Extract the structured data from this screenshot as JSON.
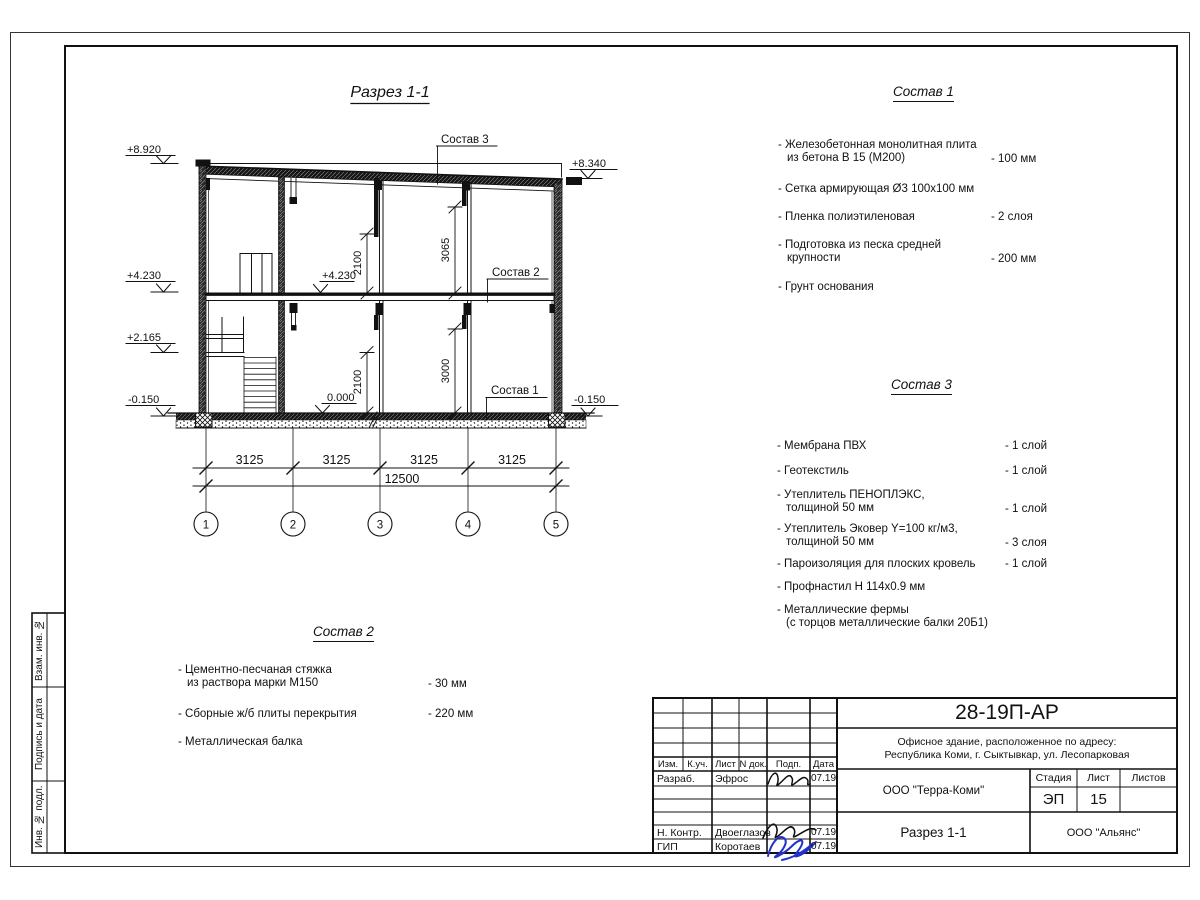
{
  "drawing": {
    "title": "Разрез 1-1",
    "elev": {
      "e8920": "+8.920",
      "e8340": "+8.340",
      "e4230m": "+4.230",
      "e2165": "+2.165",
      "e0150l": "-0.150",
      "e0150r": "-0.150",
      "e4230i": "+4.230",
      "e0000": "0.000"
    },
    "dims": {
      "d2100u": "2100",
      "d3065": "3065",
      "d2100l": "2100",
      "d3000": "3000",
      "bays": [
        "3125",
        "3125",
        "3125",
        "3125"
      ],
      "total": "12500"
    },
    "axes": [
      "1",
      "2",
      "3",
      "4",
      "5"
    ],
    "leaders": {
      "s3": "Состав 3",
      "s2": "Состав 2",
      "s1": "Состав 1"
    }
  },
  "lists": {
    "s1": {
      "title": "Состав 1",
      "items": [
        {
          "t1": "- Железобетонная  монолитная плита",
          "t2": "из бетона В 15 (М200)",
          "v": "- 100 мм"
        },
        {
          "t1": "- Сетка армирующая Ø3 100х100 мм",
          "t2": "",
          "v": ""
        },
        {
          "t1": "- Пленка полиэтиленовая",
          "t2": "",
          "v": "-  2 слоя"
        },
        {
          "t1": "- Подготовка из песка средней",
          "t2": "крупности",
          "v": "- 200 мм"
        },
        {
          "t1": "- Грунт основания",
          "t2": "",
          "v": ""
        }
      ]
    },
    "s2": {
      "title": "Состав 2",
      "items": [
        {
          "t1": "- Цементно-песчаная стяжка",
          "t2": "из раствора марки М150",
          "v": "- 30 мм"
        },
        {
          "t1": "- Сборные ж/б плиты перекрытия",
          "t2": "",
          "v": "- 220 мм"
        },
        {
          "t1": "- Металлическая балка",
          "t2": "",
          "v": ""
        }
      ]
    },
    "s3": {
      "title": "Состав 3",
      "items": [
        {
          "t1": "- Мембрана ПВХ",
          "t2": "",
          "v": "- 1 слой"
        },
        {
          "t1": "- Геотекстиль",
          "t2": "",
          "v": "- 1 слой"
        },
        {
          "t1": "- Утеплитель ПЕНОПЛЭКС,",
          "t2": "толщиной 50 мм",
          "v": "- 1 слой"
        },
        {
          "t1": "- Утеплитель Эковер Y=100 кг/м3,",
          "t2": "толщиной 50 мм",
          "v": "- 3 слоя"
        },
        {
          "t1": "- Пароизоляция для плоских кровель",
          "t2": "",
          "v": "- 1 слой"
        },
        {
          "t1": "- Профнастил Н 114х0.9 мм",
          "t2": "",
          "v": ""
        },
        {
          "t1": "- Металлические фермы",
          "t2": "(с торцов металлические балки 20Б1)",
          "v": ""
        }
      ]
    }
  },
  "titleblock": {
    "doc_number": "28-19П-АР",
    "address_line1": "Офисное здание, расположенное по адресу:",
    "address_line2": "Республика Коми, г. Сыктывкар, ул. Лесопарковая",
    "org": "ООО \"Терра-Коми\"",
    "sheet_title": "Разрез 1-1",
    "org2": "ООО \"Альянс\"",
    "stage_label": "Стадия",
    "sheet_label": "Лист",
    "sheets_label": "Листов",
    "stage": "ЭП",
    "sheet": "15",
    "cols": {
      "izm": "Изм.",
      "kuch": "К.уч.",
      "list": "Лист",
      "ndok": "N док.",
      "podp": "Подп.",
      "data": "Дата"
    },
    "rows": [
      {
        "role": "Разраб.",
        "name": "Эфрос",
        "date": "07.19"
      },
      {
        "role": "Н. Контр.",
        "name": "Двоеглазов",
        "date": "07.19"
      },
      {
        "role": "ГИП",
        "name": "Коротаев",
        "date": "07.19"
      }
    ]
  },
  "sidebar": {
    "labels": [
      "Взам. инв. №",
      "Подпись и дата",
      "Инв. № подл."
    ]
  }
}
